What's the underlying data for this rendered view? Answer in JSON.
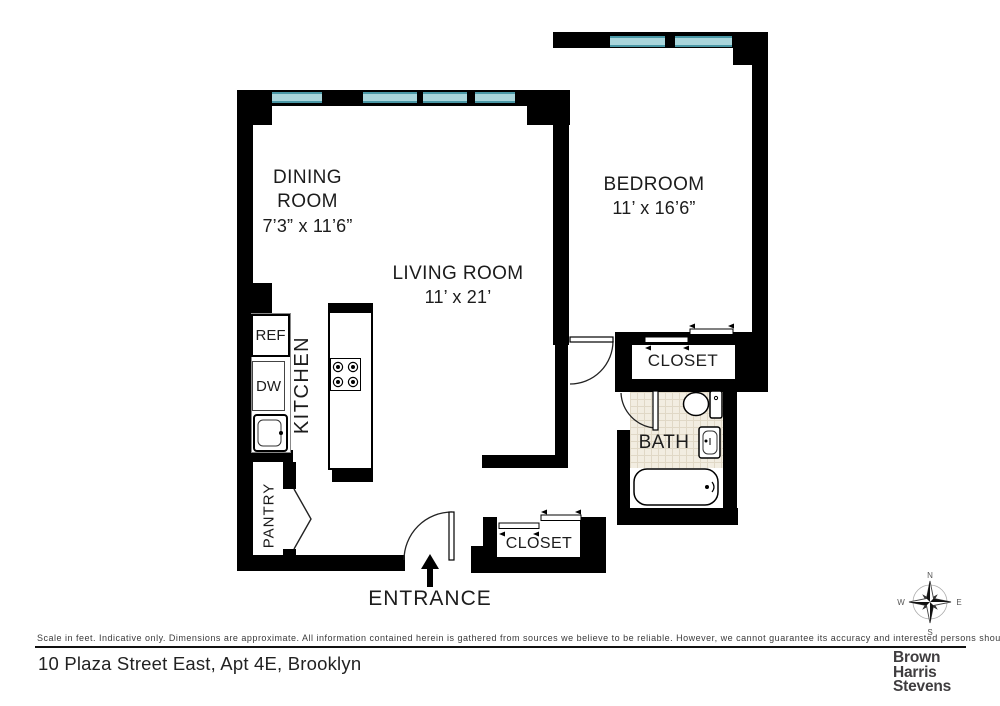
{
  "rooms": {
    "dining": {
      "line1": "DINING",
      "line2": "ROOM",
      "dims": "7’3” x 11’6”"
    },
    "living": {
      "name": "LIVING ROOM",
      "dims": "11’ x 21’"
    },
    "bedroom": {
      "name": "BEDROOM",
      "dims": "11’ x 16’6”"
    }
  },
  "labels": {
    "kitchen": "KITCHEN",
    "pantry": "PANTRY",
    "bath": "BATH",
    "closet": "CLOSET",
    "entrance": "ENTRANCE",
    "ref": "REF",
    "dw": "DW"
  },
  "compass": {
    "n": "N",
    "e": "E",
    "s": "S",
    "w": "W"
  },
  "footer": {
    "disclaimer": "Scale in feet. Indicative only. Dimensions are approximate. All information contained herein is gathered from sources we believe to be reliable. However, we cannot guarantee its accuracy and interested persons should rely on their own inquiries.",
    "address": "10 Plaza Street East, Apt 4E, Brooklyn",
    "brand_lines": [
      "Brown",
      "Harris",
      "Stevens"
    ]
  },
  "colors": {
    "wall": "#000000",
    "window_teal": "#8fc5ce",
    "window_edge": "#4a98a6",
    "bath_tile": "#f2ede1"
  }
}
